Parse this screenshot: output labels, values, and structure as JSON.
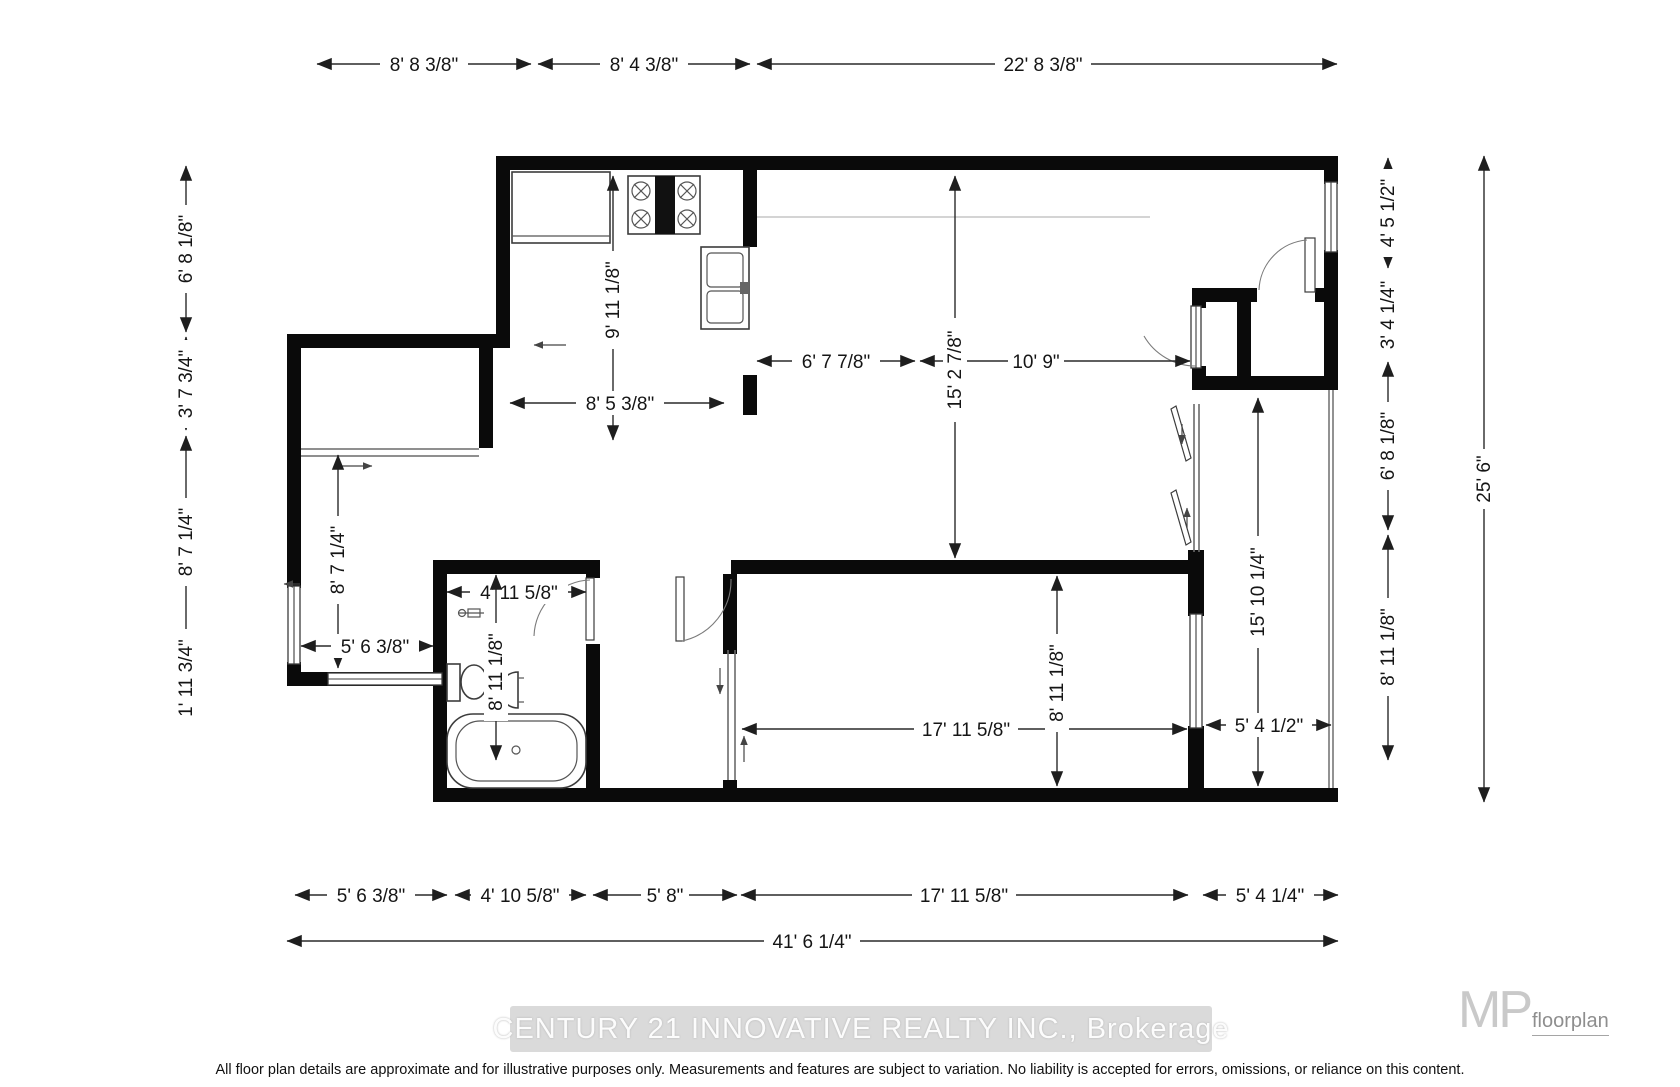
{
  "footer": {
    "watermark": "CENTURY 21 INNOVATIVE REALTY INC., Brokerage",
    "disclaimer": "All floor plan details are approximate and for illustrative purposes only. Measurements and features are subject to variation. No liability is accepted for errors, omissions, or reliance on this content.",
    "logo": {
      "monogram": "MP",
      "name": "floorplan"
    }
  },
  "dims": {
    "top_left": "8' 8 3/8\"",
    "top_mid": "8' 4 3/8\"",
    "top_right": "22' 8 3/8\"",
    "left_1": "6' 8 1/8\"",
    "left_2": "3' 7 3/4\"",
    "left_3": "8' 7 1/4\"",
    "left_4": "1' 11 3/4\"",
    "right_1": "4' 5 1/2\"",
    "right_2": "3' 4 1/4\"",
    "right_3": "6' 8 1/8\"",
    "right_4": "8' 11 1/8\"",
    "right_total": "25' 6\"",
    "bottom_1": "5' 6 3/8\"",
    "bottom_2": "4' 10 5/8\"",
    "bottom_3": "5' 8\"",
    "bottom_4": "17' 11 5/8\"",
    "bottom_5": "5' 4 1/4\"",
    "bottom_total": "41' 6 1/4\"",
    "kitchen_h": "9' 11 1/8\"",
    "kitchen_w": "8' 5 3/8\"",
    "living_w1": "6' 7 7/8\"",
    "living_h": "15' 2 7/8\"",
    "living_w2": "10' 9\"",
    "hall_h": "8' 7 1/4\"",
    "leftroom_w": "5' 6 3/8\"",
    "bath_w": "4' 11 5/8\"",
    "bath_h": "8' 11 1/8\"",
    "bed_w": "17' 11 5/8\"",
    "bed_h": "8' 11 1/8\"",
    "balcony_h": "15' 10 1/4\"",
    "balcony_w": "5' 4 1/2\""
  }
}
